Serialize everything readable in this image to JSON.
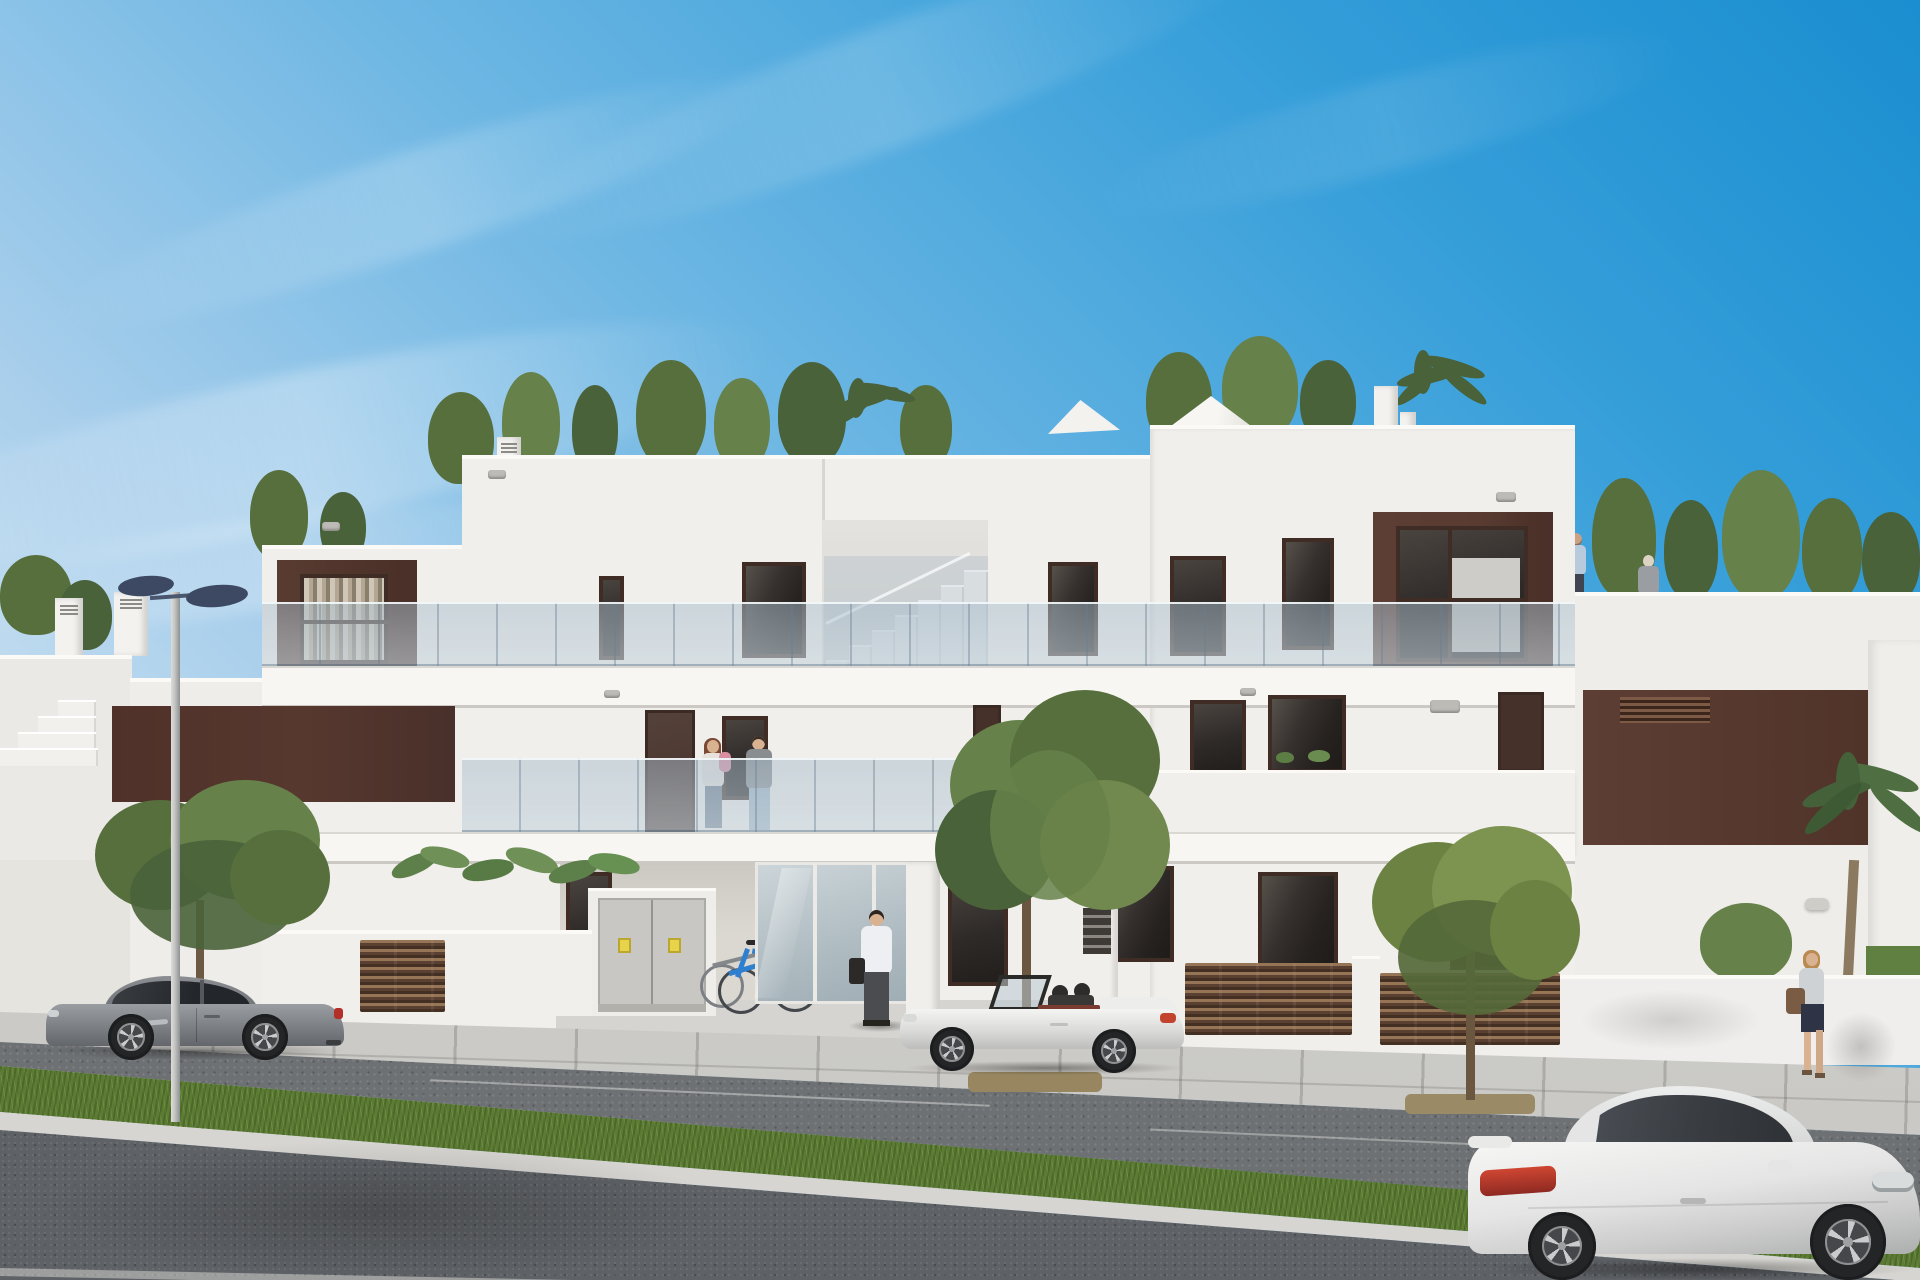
{
  "scene": {
    "type": "architectural-3d-render",
    "setting": "modern white two/three-storey apartment block with brown accent panels, glass balconies, rooftop terraces with plants, street with parked cars and pedestrians, clear blue sky",
    "time_of_day": "day"
  },
  "palette": {
    "skyTop": "#1a8ed0",
    "skyMid": "#6cb6e3",
    "skyLow": "#cfe3f2",
    "facade": "#f1efeb",
    "facadeShade": "#dedcd6",
    "porchShade": "#d3d0c9",
    "slab": "#f7f6f2",
    "brown": "#593b31",
    "brownDark": "#46312a",
    "brownBand": "#57382f",
    "frame": "#3f2d25",
    "glassDark": "#2e2a28",
    "grass": "#5c7c33",
    "asphalt": "#6e7174",
    "asphaltFore": "#5e6165",
    "sidewalk": "#c9c8c4",
    "curb": "#d6d5d1",
    "fence": "#5a4030",
    "treeA": "#566f3d",
    "treeB": "#66814a",
    "treeC": "#49623a",
    "trunk": "#6d5a45",
    "carGray": "#8f9296",
    "carWhite": "#efefee",
    "tailRed": "#c0392b",
    "lampHead": "#3d4963",
    "pole": "#c6c6c4",
    "skin": "#d9b291",
    "cabinet": "#c8c7c3",
    "stickerYellow": "#e8d44a",
    "bikeBlue": "#2f7fd0"
  },
  "objects": {
    "building": {
      "main_blocks": [
        "left wing",
        "center block with open stairwell",
        "right tall block",
        "right low wing"
      ],
      "features": [
        "brown window boxes with curtains",
        "frameless glass balustrades",
        "white parapet balconies",
        "roof terrace with conifers and palms",
        "white parasol on roof",
        "chimneys",
        "utility cabinet with two warning stickers",
        "glass entrance door",
        "mailbox pillar",
        "brown slatted fences and gate"
      ]
    },
    "vehicles": [
      {
        "name": "gray sports coupe",
        "position": "parked left, facing left"
      },
      {
        "name": "white convertible roadster",
        "position": "parked center, top down, facing left"
      },
      {
        "name": "white sports coupe",
        "position": "foreground right, facing right"
      }
    ],
    "people": [
      {
        "name": "couple with baby",
        "position": "first-floor balcony center"
      },
      {
        "name": "man with bag",
        "position": "walking to entrance"
      },
      {
        "name": "woman with shoulder bag",
        "position": "right sidewalk"
      },
      {
        "name": "man climbing stairs",
        "position": "roof terrace right"
      },
      {
        "name": "woman",
        "position": "roof terrace right"
      }
    ],
    "street": [
      "paved sidewalk with large slabs",
      "parking lane",
      "grass median strip",
      "foreground asphalt road",
      "double-head street lamp",
      "two bicycles at rack",
      "three small trees",
      "palm tree far right"
    ]
  }
}
